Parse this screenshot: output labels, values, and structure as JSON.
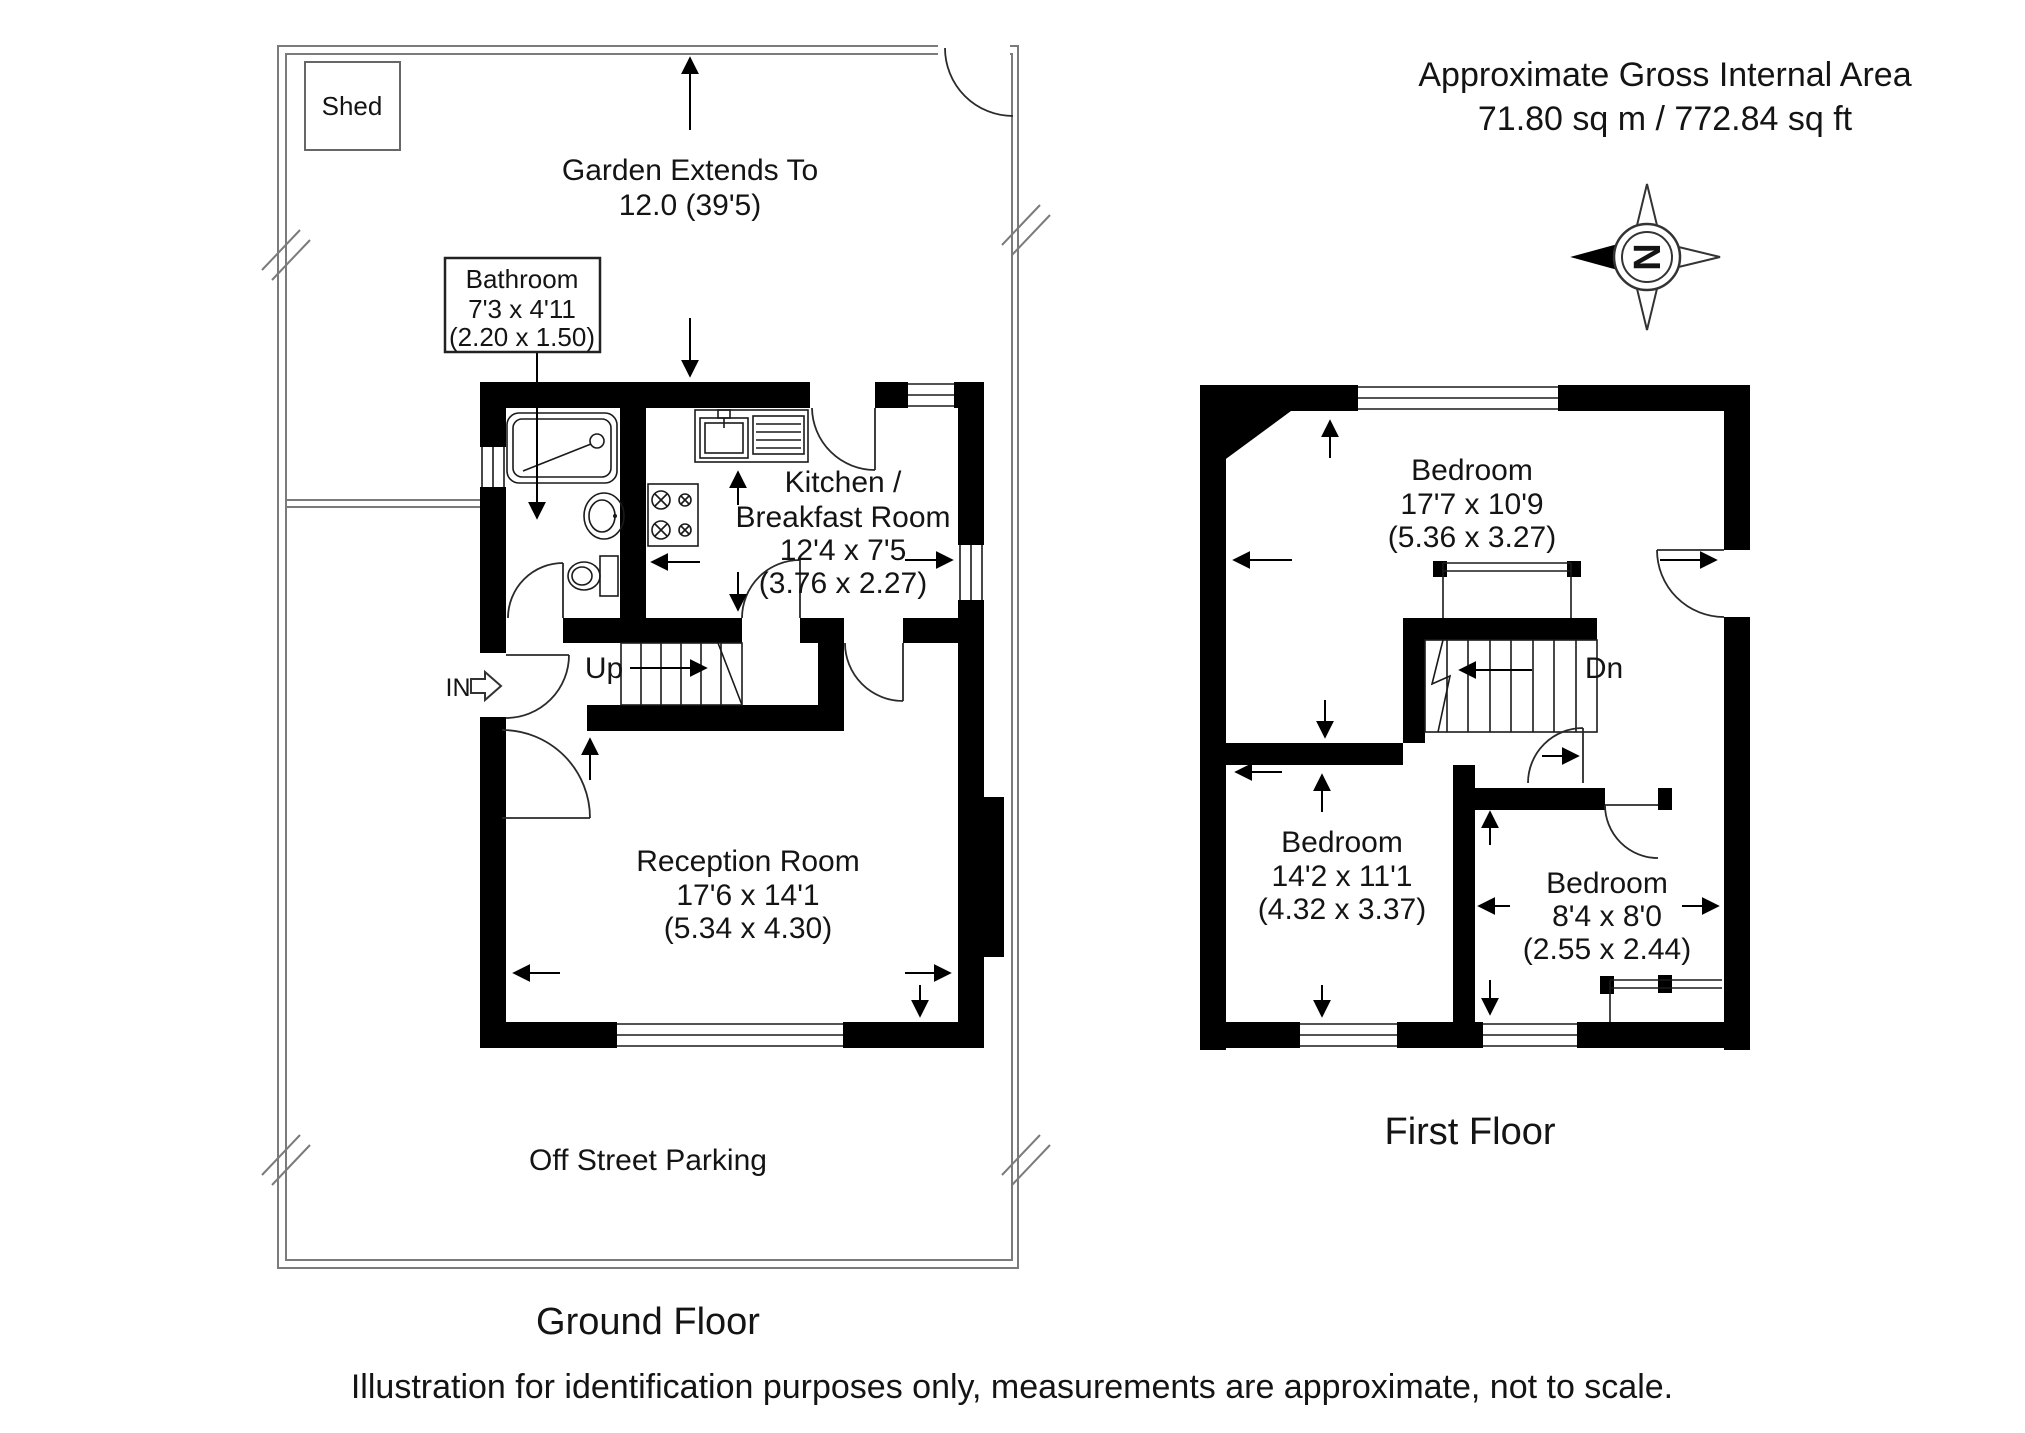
{
  "header": {
    "line1": "Approximate Gross Internal Area",
    "line2": "71.80 sq m / 772.84 sq ft"
  },
  "compass": {
    "letter": "N"
  },
  "ground_floor": {
    "title": "Ground Floor",
    "shed_label": "Shed",
    "garden_label": {
      "line1": "Garden Extends To",
      "line2": "12.0 (39'5)"
    },
    "parking_label": "Off Street Parking",
    "in_label": "IN",
    "up_label": "Up",
    "rooms": {
      "bathroom": {
        "name": "Bathroom",
        "imperial": "7'3 x 4'11",
        "metric": "(2.20 x 1.50)"
      },
      "kitchen": {
        "name_line1": "Kitchen /",
        "name_line2": "Breakfast Room",
        "imperial": "12'4 x 7'5",
        "metric": "(3.76 x 2.27)"
      },
      "reception": {
        "name": "Reception Room",
        "imperial": "17'6 x 14'1",
        "metric": "(5.34 x 4.30)"
      }
    }
  },
  "first_floor": {
    "title": "First Floor",
    "dn_label": "Dn",
    "rooms": {
      "bedroom1": {
        "name": "Bedroom",
        "imperial": "17'7 x 10'9",
        "metric": "(5.36 x 3.27)"
      },
      "bedroom2": {
        "name": "Bedroom",
        "imperial": "14'2 x 11'1",
        "metric": "(4.32 x 3.37)"
      },
      "bedroom3": {
        "name": "Bedroom",
        "imperial": "8'4 x 8'0",
        "metric": "(2.55 x 2.44)"
      }
    }
  },
  "footer": {
    "disclaimer": "Illustration for identification purposes only, measurements are approximate, not to scale."
  },
  "colors": {
    "wall": "#000000",
    "boundary": "#7b7b7b",
    "text": "#141414"
  }
}
